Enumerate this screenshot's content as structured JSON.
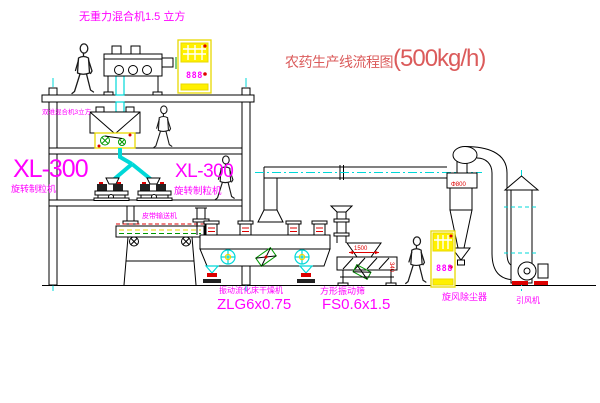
{
  "title": {
    "text": "农药生产线流程图",
    "capacity": "(500kg/h)"
  },
  "equipment_labels": {
    "gravity_mixer": "无重力混合机1.5 立方",
    "second_mixer": "双维混合机3立方",
    "granulator_left": {
      "model": "XL-300",
      "name": "旋转制粒机"
    },
    "granulator_right": {
      "model": "XL-300",
      "name": "旋转制粒机"
    },
    "belt_conveyor": "皮带输送机",
    "fluid_bed_dryer": {
      "name": "振动流化床干燥机",
      "model": "ZLG6x0.75"
    },
    "square_sieve": {
      "name": "方形振动筛",
      "model": "FS0.6x1.5"
    },
    "cyclone": "旋风除尘器",
    "induced_draft_fan": "引风机"
  },
  "dimension_annotations": {
    "cyclone_diameter": "Φ800",
    "sieve_length": "1500",
    "sieve_height": "340"
  },
  "control_panel": {
    "display_left": "888",
    "display_right": "888"
  },
  "colors": {
    "label_magenta": "#ff00ff",
    "title_red": "#db5b5b",
    "dimension_red": "#dd0000",
    "centerline_cyan": "#00d8d8",
    "panel_yellow": "#fff000",
    "machine_green": "#009900"
  }
}
